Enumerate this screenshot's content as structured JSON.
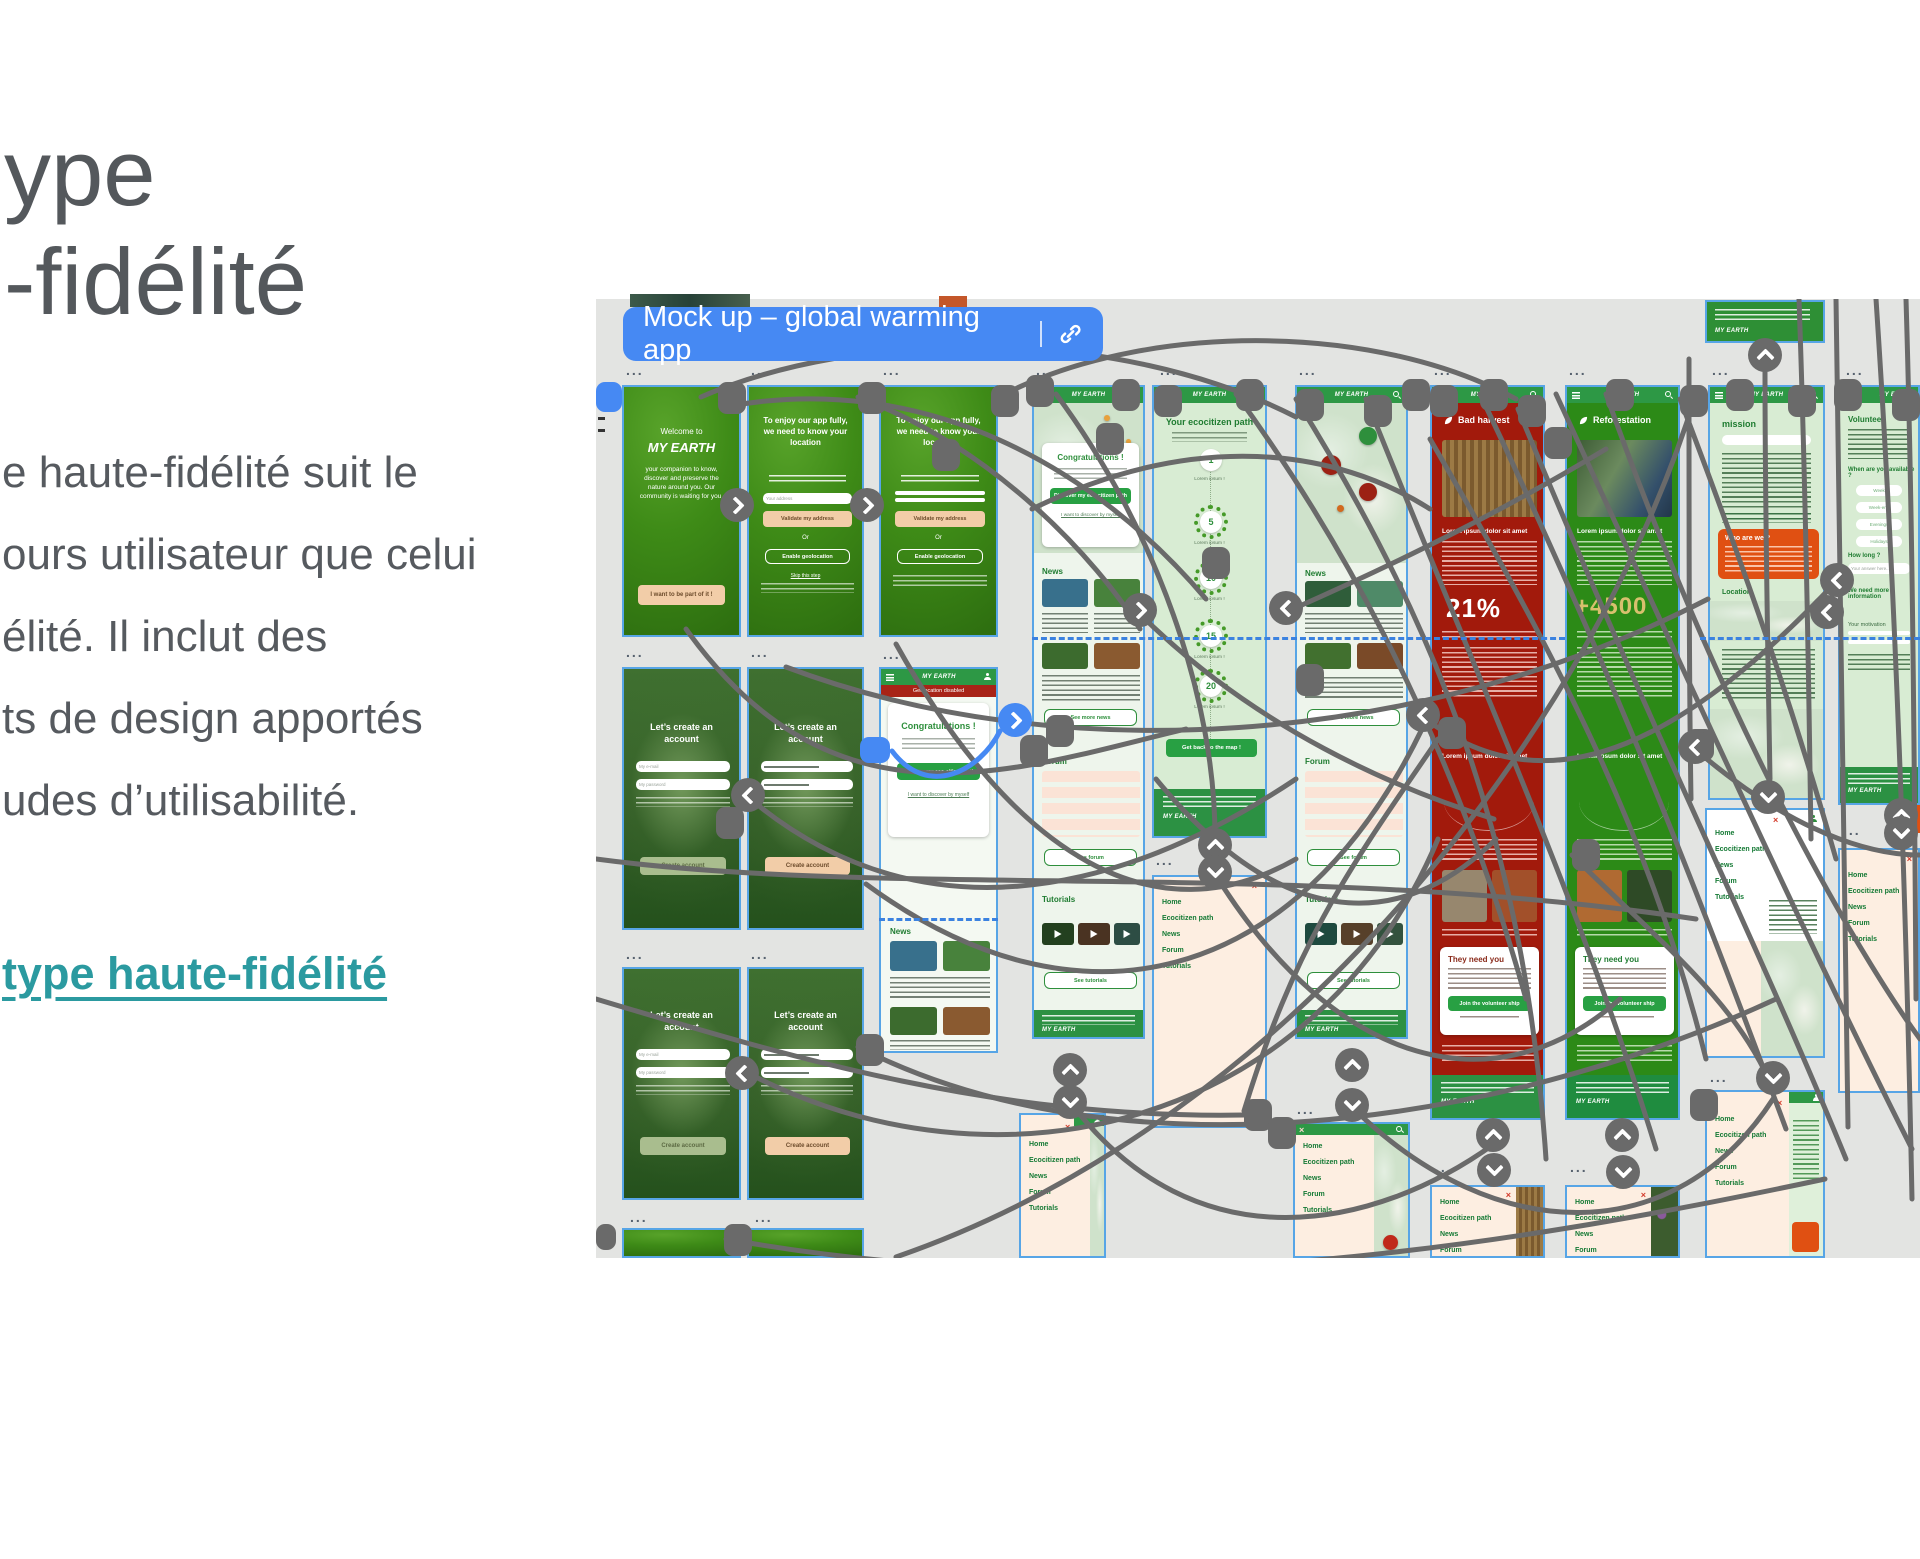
{
  "slide": {
    "heading_lines": [
      "ype",
      "-fidélité"
    ],
    "paragraph_lines": [
      "e haute-fidélité suit le",
      "ours utilisateur que celui",
      "élité. Il inclut des",
      "ts de design apportés",
      "udes d’utilisabilité."
    ],
    "link_text": "type haute-fidélité"
  },
  "canvas": {
    "pill_title": "Mock up – global warming app",
    "frame_dots": "...",
    "appbar_logo": "MY EARTH",
    "frames": {
      "splash": {
        "welcome": "Welcome to",
        "logo": "MY EARTH",
        "body": "your companion to know, discover and preserve the nature around you. Our community is waiting for you.",
        "cta": "I want to be part of it !"
      },
      "location": {
        "title": "To enjoy our app fully, we need to know your location",
        "address_placeholder": "Your address",
        "validate": "Validate my address",
        "or": "Or",
        "geolocation": "Enable geolocation",
        "skip": "Skip this step"
      },
      "account": {
        "title": "Let’s create an account",
        "field_email": "My e-mail",
        "field_password": "My password",
        "cta": "Create account"
      },
      "congrats": {
        "banner": "Geolocation disabled",
        "title": "Congratulations !",
        "cta": "Discover my eco-citizen path",
        "alt": "I want to discover by myself"
      },
      "path": {
        "title": "Your ecocitizen path",
        "steps": [
          "1",
          "5",
          "10",
          "15",
          "20"
        ],
        "caption": "Lorem ipsum !",
        "cta": "Get back to the map !"
      },
      "home": {
        "news": "News",
        "see_news": "See more news",
        "forum": "Forum",
        "see_forum": "See forum",
        "tutorials": "Tutorials",
        "see_tutorials": "See tutorials"
      },
      "bad_harvest": {
        "title": "Bad harvest",
        "lead": "Lorem ipsum dolor sit amet",
        "stat": "21%",
        "card": "They need you",
        "cta": "Join the volunteer ship"
      },
      "reforestation": {
        "title": "Reforestation",
        "lead": "Lorem ipsum dolor sit amet",
        "stat": "+4500",
        "card": "They need you",
        "cta": "Join the volunteer ship"
      },
      "mission": {
        "title": "mission",
        "who": "Who are we ?",
        "location": "Location"
      },
      "volunteer": {
        "title": "Volunteer",
        "availability": "When are you available ?",
        "options": [
          "Week",
          "Week-end",
          "Evenings",
          "Holidays"
        ],
        "how_long": "How long ?",
        "answer": "Your answer here...",
        "more_info": "We need more information",
        "motivation": "Your motivation"
      },
      "menu": {
        "items": [
          "Home",
          "Ecocitizen path",
          "News",
          "Forum",
          "Tutorials"
        ]
      }
    }
  },
  "colors": {
    "link_teal": "#2b9aa0",
    "pill_blue": "#4689f3",
    "canvas_bg": "#e3e4e2",
    "connector": "#6a6a6a",
    "app_green": "#2d9845",
    "dark_red": "#a21a0c",
    "orange": "#e05012",
    "peach": "#f2cda8",
    "menu_peach": "#fdeee1",
    "stat_gold": "#d8c06e"
  }
}
